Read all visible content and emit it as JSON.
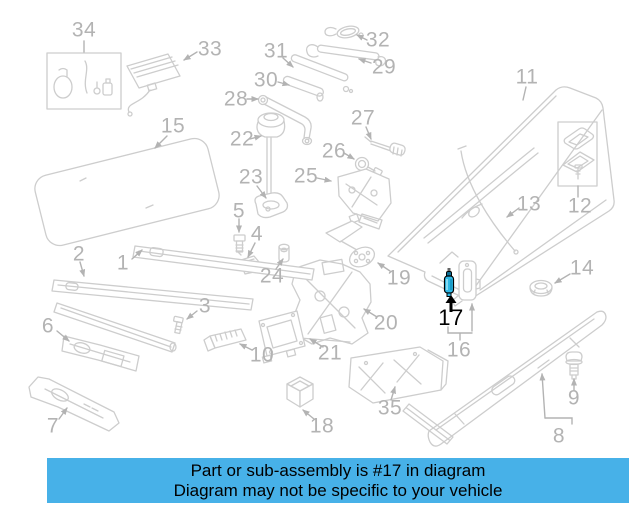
{
  "colors": {
    "background": "#ffffff",
    "diagram_line": "#cdcdcd",
    "label_gray": "#b3b3b3",
    "highlight_fill": "#2fb9e6",
    "highlight_dark": "#0d6e94",
    "highlight_label": "#000000",
    "banner_bg": "#47b1e8",
    "banner_text": "#000000"
  },
  "diagram": {
    "highlighted_part": "17",
    "labels": [
      {
        "text": "34",
        "x": 84,
        "y": 30
      },
      {
        "text": "33",
        "x": 210,
        "y": 49
      },
      {
        "text": "31",
        "x": 276,
        "y": 51
      },
      {
        "text": "32",
        "x": 378,
        "y": 40
      },
      {
        "text": "29",
        "x": 384,
        "y": 67
      },
      {
        "text": "30",
        "x": 266,
        "y": 80
      },
      {
        "text": "28",
        "x": 236,
        "y": 99
      },
      {
        "text": "27",
        "x": 363,
        "y": 118
      },
      {
        "text": "11",
        "x": 527,
        "y": 77
      },
      {
        "text": "15",
        "x": 173,
        "y": 126
      },
      {
        "text": "22",
        "x": 242,
        "y": 139
      },
      {
        "text": "26",
        "x": 334,
        "y": 151
      },
      {
        "text": "25",
        "x": 306,
        "y": 176
      },
      {
        "text": "23",
        "x": 251,
        "y": 177
      },
      {
        "text": "13",
        "x": 529,
        "y": 204
      },
      {
        "text": "12",
        "x": 580,
        "y": 206
      },
      {
        "text": "5",
        "x": 239,
        "y": 211
      },
      {
        "text": "4",
        "x": 257,
        "y": 234
      },
      {
        "text": "2",
        "x": 79,
        "y": 254
      },
      {
        "text": "1",
        "x": 123,
        "y": 263
      },
      {
        "text": "14",
        "x": 582,
        "y": 268
      },
      {
        "text": "24",
        "x": 272,
        "y": 276
      },
      {
        "text": "19",
        "x": 399,
        "y": 278
      },
      {
        "text": "3",
        "x": 205,
        "y": 306
      },
      {
        "text": "17",
        "x": 451,
        "y": 318,
        "highlight": true
      },
      {
        "text": "20",
        "x": 386,
        "y": 323
      },
      {
        "text": "6",
        "x": 48,
        "y": 326
      },
      {
        "text": "16",
        "x": 459,
        "y": 350
      },
      {
        "text": "10",
        "x": 262,
        "y": 355
      },
      {
        "text": "21",
        "x": 330,
        "y": 353
      },
      {
        "text": "35",
        "x": 390,
        "y": 408
      },
      {
        "text": "9",
        "x": 574,
        "y": 398
      },
      {
        "text": "18",
        "x": 322,
        "y": 426
      },
      {
        "text": "7",
        "x": 53,
        "y": 426
      },
      {
        "text": "8",
        "x": 559,
        "y": 436
      }
    ]
  },
  "banner": {
    "line1": "Part or sub-assembly is #17 in diagram",
    "line2": "Diagram may not be specific to your vehicle"
  }
}
